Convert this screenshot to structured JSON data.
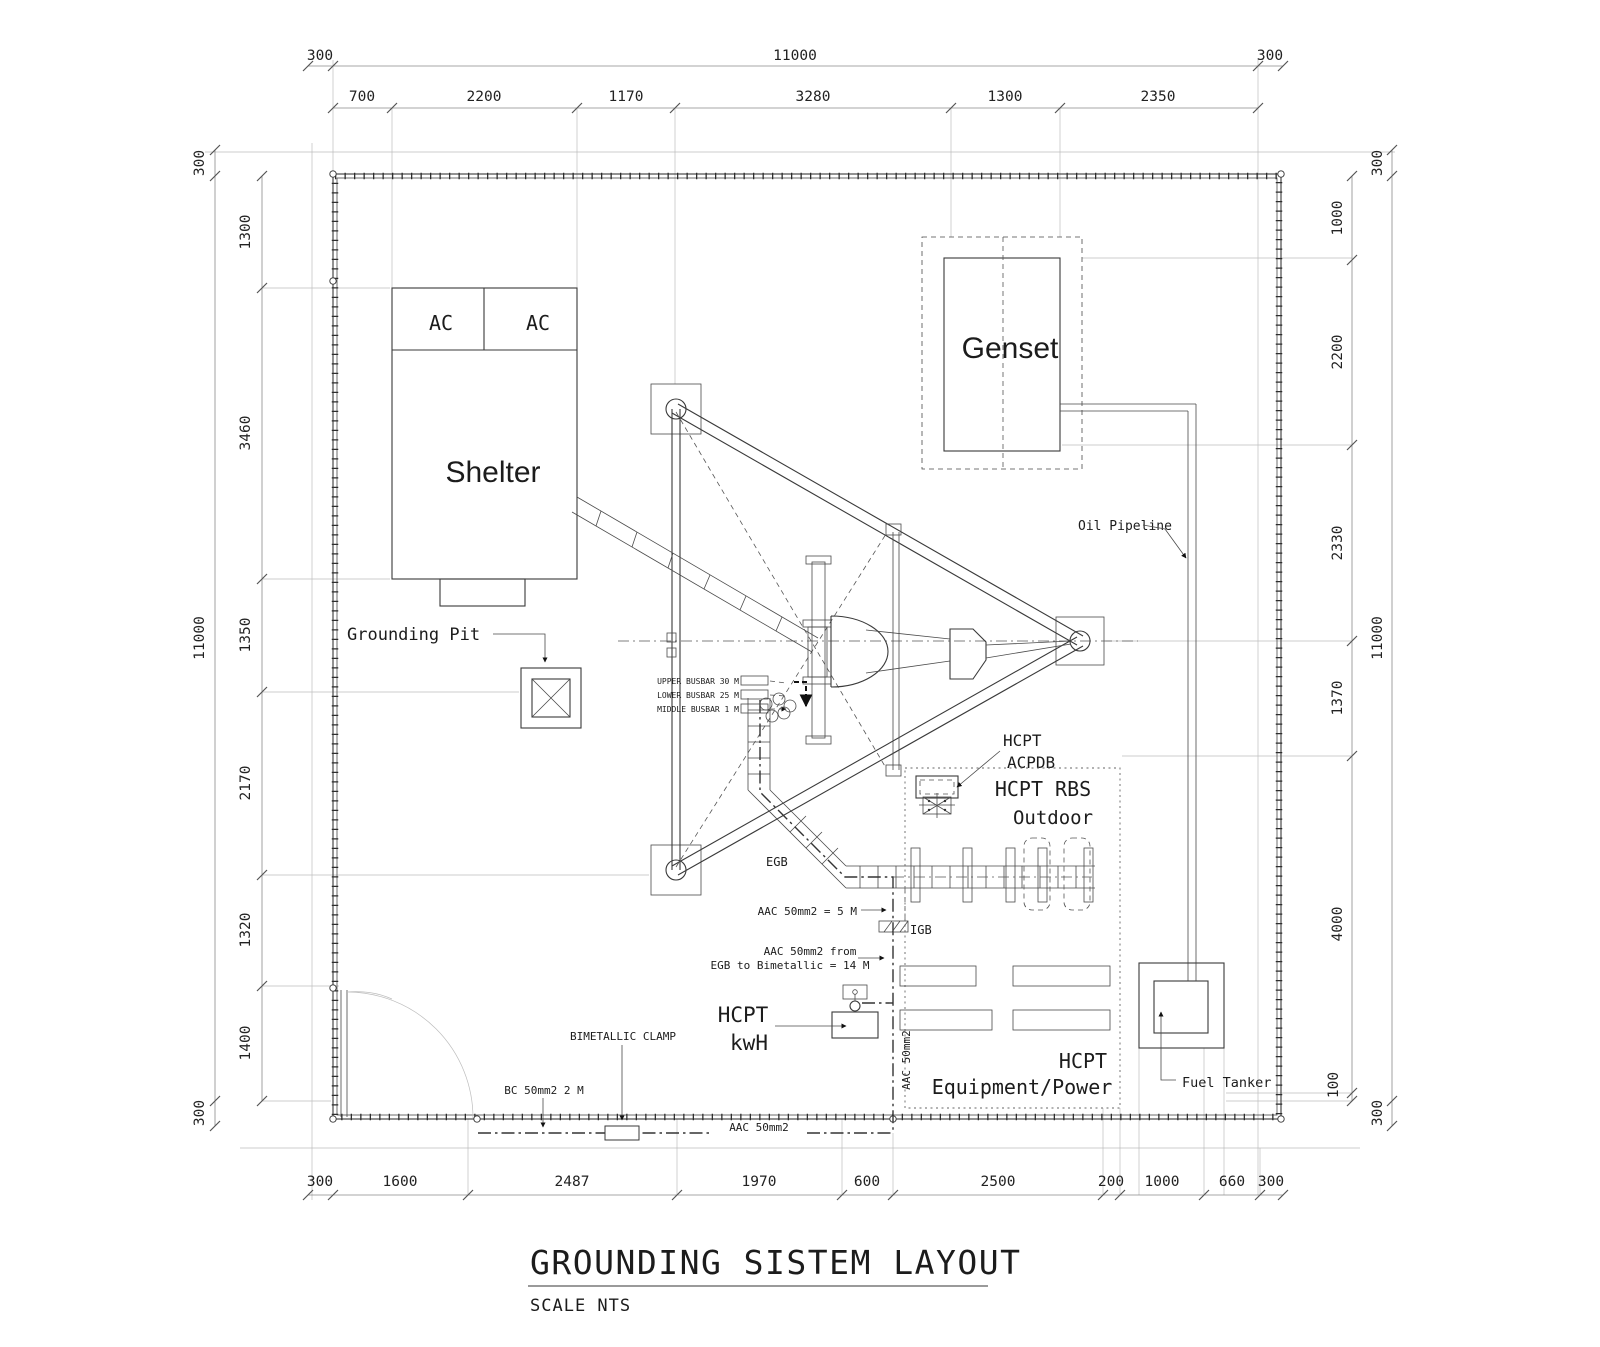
{
  "title": {
    "text": "GROUNDING SISTEM LAYOUT",
    "scale_label": "SCALE  NTS"
  },
  "dimensions": {
    "top_outer": [
      "300",
      "11000",
      "300"
    ],
    "top_inner": [
      "700",
      "2200",
      "1170",
      "3280",
      "1300",
      "2350"
    ],
    "left_outer": [
      "300",
      "11000",
      "300"
    ],
    "left_inner": [
      "1300",
      "3460",
      "1350",
      "2170",
      "1320",
      "1400"
    ],
    "right_outer": [
      "300",
      "11000",
      "300"
    ],
    "right_inner": [
      "1000",
      "2200",
      "2330",
      "1370",
      "4000",
      "100"
    ],
    "bottom": [
      "300",
      "1600",
      "2487",
      "1970",
      "600",
      "2500",
      "200",
      "1000",
      "660",
      "300"
    ]
  },
  "labels": {
    "shelter": "Shelter",
    "ac_left": "AC",
    "ac_right": "AC",
    "genset": "Genset",
    "grounding_pit": "Grounding Pit",
    "oil_pipeline": "Oil Pipeline",
    "hcpt_acpdb_line1": "HCPT",
    "hcpt_acpdb_line2": "ACPDB",
    "rbs_line1": "HCPT RBS",
    "rbs_line2": "Outdoor",
    "egb": "EGB",
    "igb": "IGB",
    "aac_5m": "AAC 50mm2 = 5 M",
    "aac_from_line1": "AAC 50mm2 from",
    "aac_from_line2": "EGB to Bimetallic = 14 M",
    "kwh_line1": "HCPT",
    "kwh_line2": "kwH",
    "bimetallic_clamp": "BIMETALLIC CLAMP",
    "bc_50mm2": "BC 50mm2 2 M",
    "aac_bottom": "AAC 50mm2",
    "aac_vertical": "AAC 50mm2",
    "equipment_line1": "HCPT",
    "equipment_line2": "Equipment/Power",
    "fuel_tanker": "Fuel Tanker",
    "busbar_upper": "UPPER BUSBAR 30 M",
    "busbar_lower": "LOWER BUSBAR 25 M",
    "busbar_middle": "MIDDLE BUSBAR 1 M"
  }
}
